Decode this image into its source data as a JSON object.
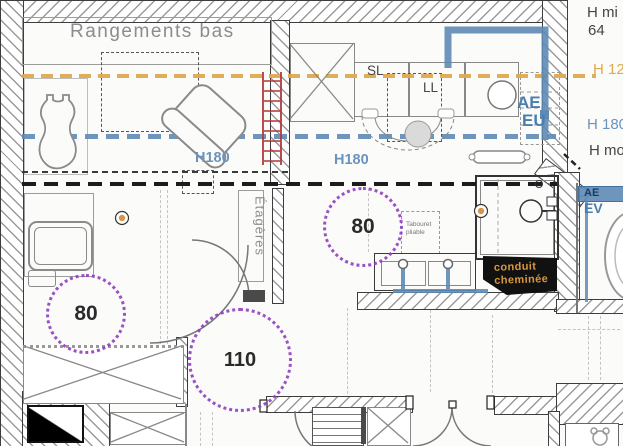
{
  "colors": {
    "orange_dash": "#DFA94F",
    "blue_dash": "#5E8AB4",
    "blue_text": "#4A7FAD",
    "purple_dots": "#8F3FBF",
    "red_ladder": "#B23A3A",
    "conduit_bg": "#111111",
    "conduit_text": "#D8973F",
    "text_gray": "#8C8C8C",
    "text_dark": "#454545"
  },
  "labels": {
    "rangements_bas": "Rangements bas",
    "h180_bedroom": "H180",
    "h180_kitchen": "H180",
    "sl": "SL",
    "ll": "LL",
    "ae_kitchen": "AE",
    "eu_kitchen": "EU",
    "etageres": "Étagères",
    "tabouret_l1": "Tabouret",
    "tabouret_l2": "pliable",
    "conduit_l1": "conduit",
    "conduit_l2": "cheminée",
    "ae_toilet": "AE",
    "ev_toilet": "EV",
    "clearance_bath": "80",
    "clearance_center": "80",
    "clearance_hall": "110"
  },
  "margin_notes": {
    "h_min": "H mi",
    "h_min_value": "64",
    "h_120": "H 120",
    "h_180": "H 180",
    "h_mo": "H mo"
  }
}
